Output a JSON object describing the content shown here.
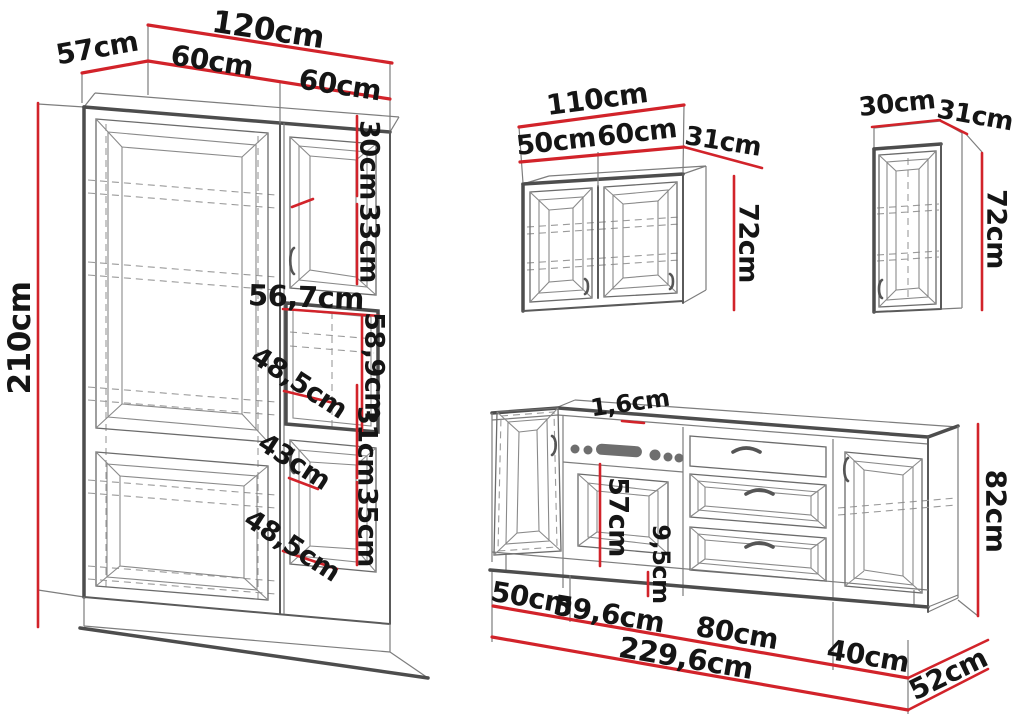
{
  "diagram": {
    "type": "kitchen-furniture-dimension-diagram",
    "colors": {
      "dimension_line": "#d2232a",
      "outline": "#4d4d4d",
      "outline_light": "#8a8a8a",
      "background": "#ffffff",
      "label_text": "#151515"
    },
    "tall_cabinet": {
      "total_width": "120cm",
      "depth": "57cm",
      "left_door_width": "60cm",
      "right_door_width": "60cm",
      "height": "210cm",
      "upper_door_width": "30cm",
      "upper_door_height": "33cm",
      "niche_width": "56,7cm",
      "niche_height": "58,9cm",
      "upper_shelf_depth": "48,5cm",
      "lower_door_width": "43cm",
      "lower_upper_height": "31cm",
      "lower_lower_height": "35cm",
      "lower_shelf_depth": "48,5cm"
    },
    "wall_cabinet": {
      "total_width": "110cm",
      "left_door_width": "50cm",
      "right_door_width": "60cm",
      "depth": "31cm",
      "height": "72cm"
    },
    "small_wall_cabinet": {
      "width": "30cm",
      "depth": "31cm",
      "height": "72cm"
    },
    "base_unit": {
      "countertop_thickness": "1,6cm",
      "oven_door_height": "57cm",
      "plinth_height": "9,5cm",
      "height": "82cm",
      "left_door_width": "50cm",
      "oven_section_width": "59,6cm",
      "drawer_section_width": "80cm",
      "right_door_width": "40cm",
      "total_width": "229,6cm",
      "depth": "52cm"
    }
  }
}
